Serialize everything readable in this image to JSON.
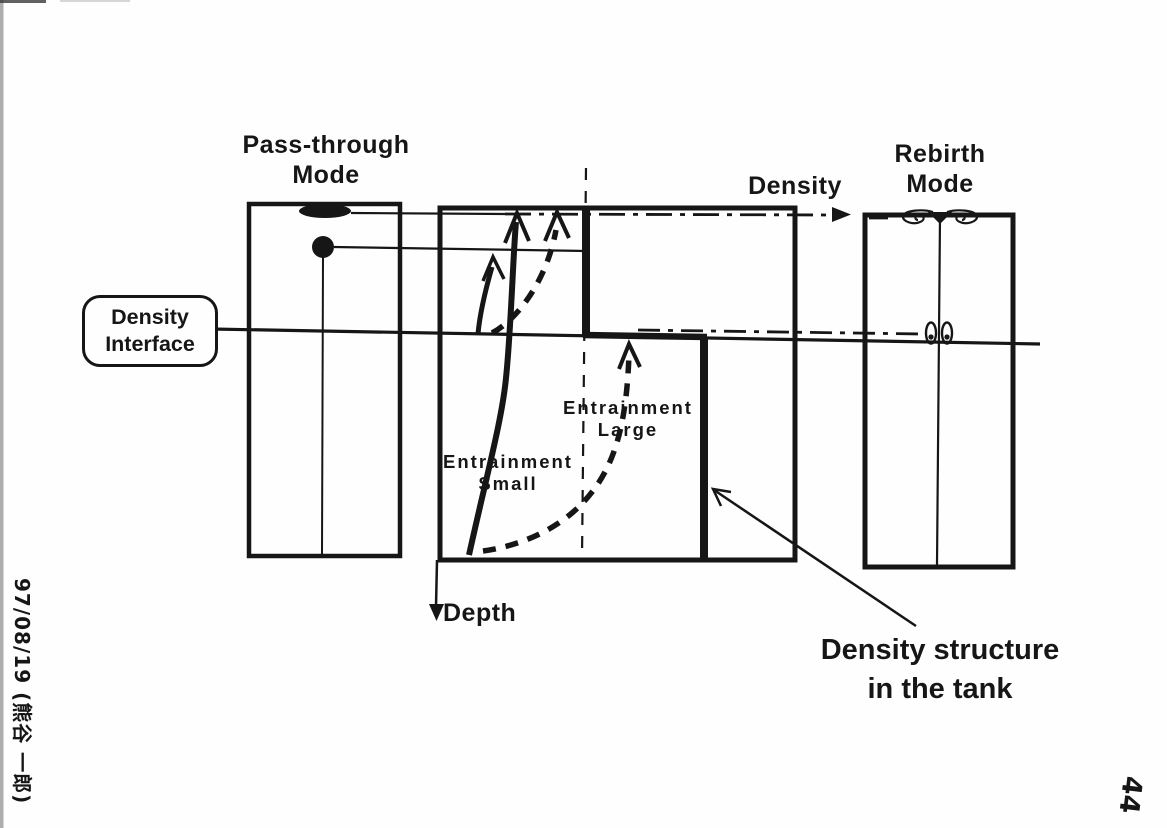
{
  "colors": {
    "ink": "#161616",
    "paper": "#fefefe"
  },
  "labels": {
    "pass_through_mode": "Pass-through\nMode",
    "rebirth_mode": "Rebirth\nMode",
    "density_interface": "Density\nInterface",
    "density_axis": "Density",
    "depth_axis": "Depth",
    "entrainment_small": "Entrainment\nSmall",
    "entrainment_large": "Entrainment\nLarge",
    "density_structure": "Density structure\nin the tank",
    "handwritten_date": "97/08/19 (熊谷 一郎)",
    "page_number": "44"
  }
}
